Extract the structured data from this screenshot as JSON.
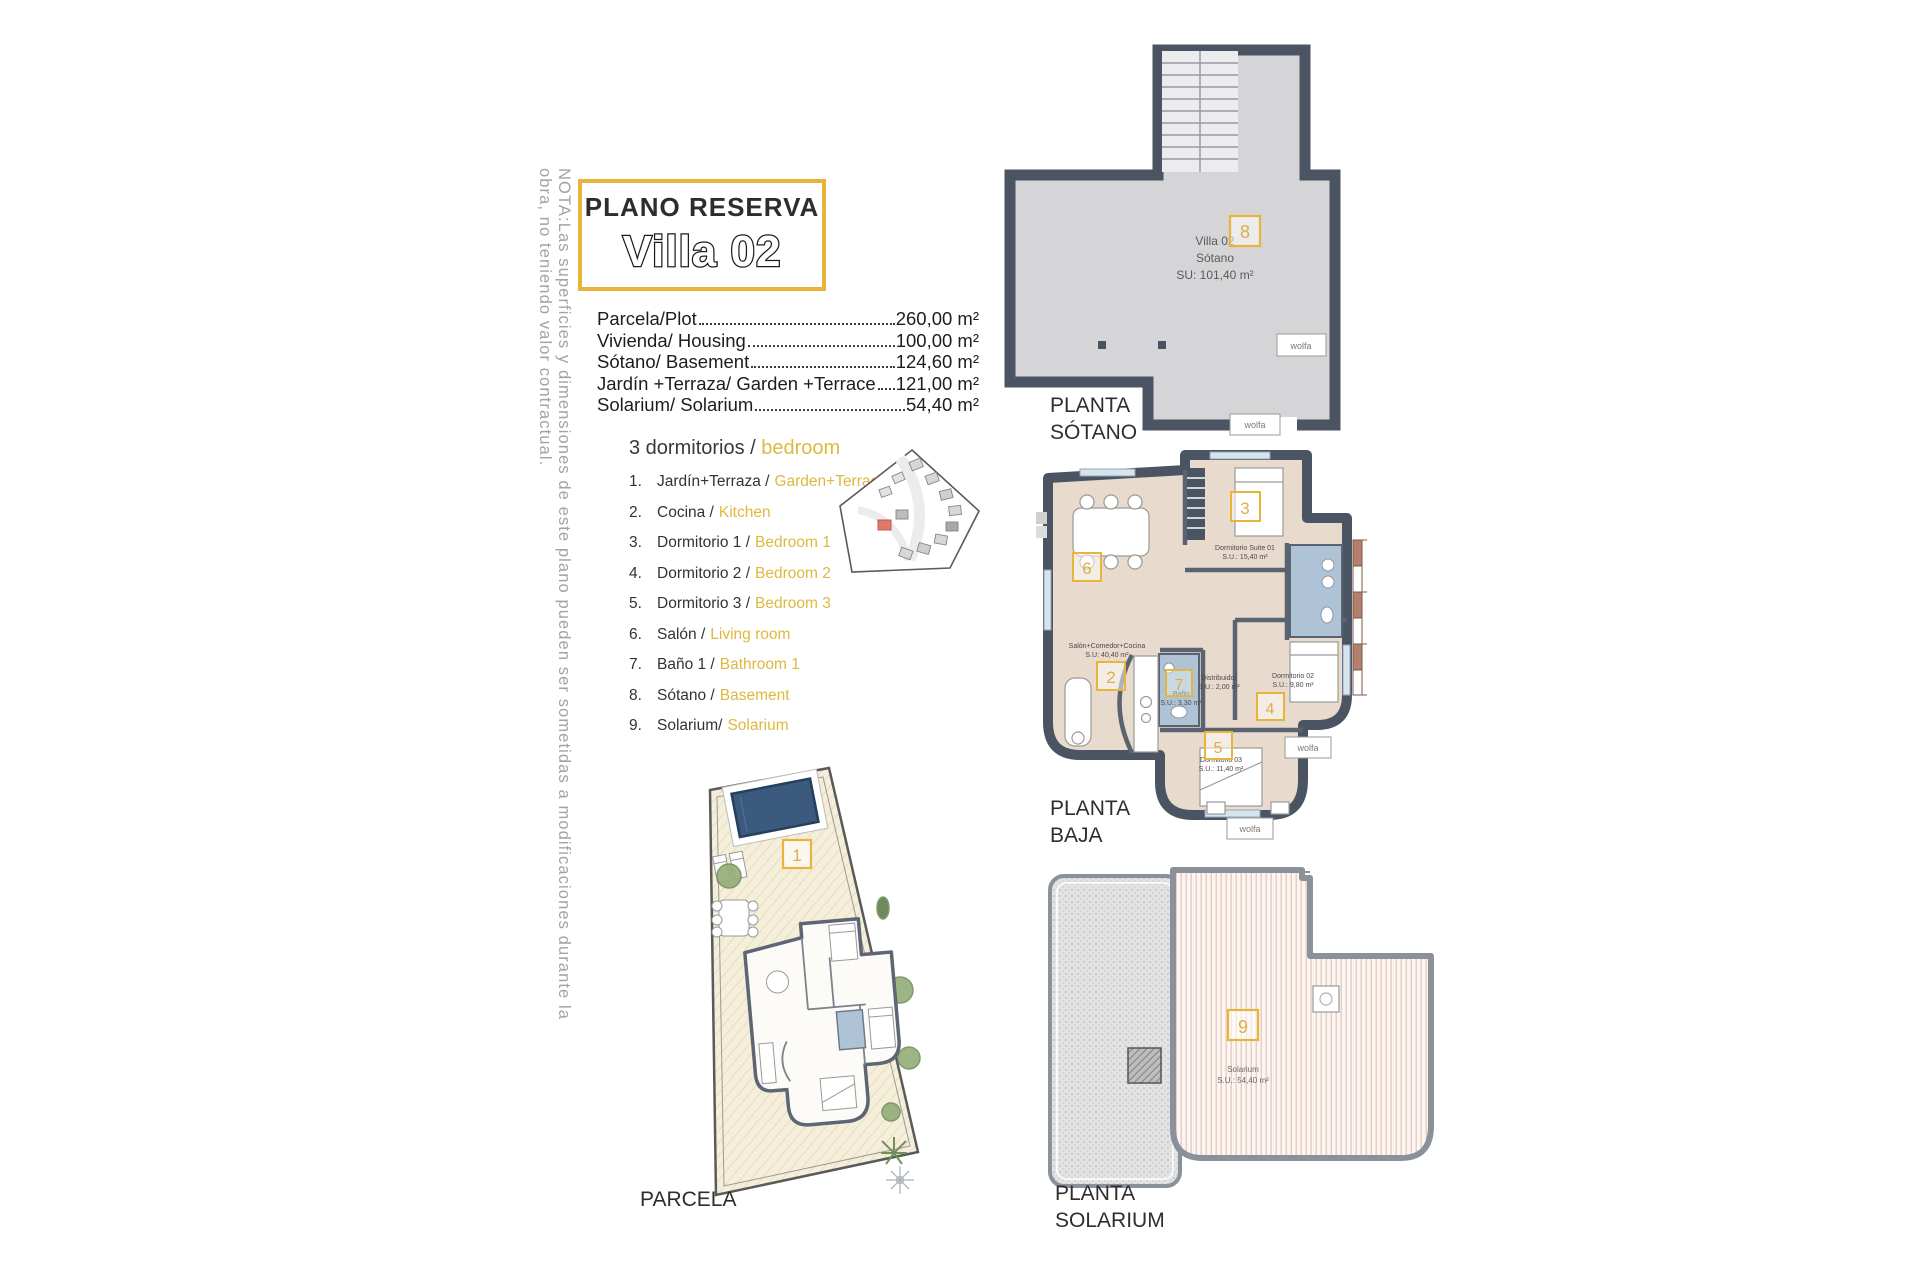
{
  "note": "NOTA:Las superficies y dimensiones de este plano pueden ser sometidas a modificaciones durante la obra, no teniendo valor contractual.",
  "title": {
    "kicker": "PLANO RESERVA",
    "name": "Villa 02"
  },
  "measurements": [
    {
      "label": "Parcela/Plot",
      "value": "260,00 m²"
    },
    {
      "label": "Vivienda/ Housing",
      "value": "100,00 m²"
    },
    {
      "label": "Sótano/ Basement",
      "value": "124,60 m²"
    },
    {
      "label": "Jardín +Terraza/ Garden +Terrace",
      "value": "121,00 m²"
    },
    {
      "label": "Solarium/ Solarium",
      "value": "54,40 m²"
    }
  ],
  "legend": {
    "heading": {
      "es": "3 dormitorios /",
      "en": "bedroom"
    },
    "items": [
      {
        "n": "1.",
        "es": "Jardín+Terraza /",
        "en": "Garden+Terrace"
      },
      {
        "n": "2.",
        "es": "Cocina /",
        "en": "Kitchen"
      },
      {
        "n": "3.",
        "es": "Dormitorio 1 /",
        "en": "Bedroom 1"
      },
      {
        "n": "4.",
        "es": "Dormitorio 2 /",
        "en": "Bedroom 2"
      },
      {
        "n": "5.",
        "es": "Dormitorio 3 /",
        "en": "Bedroom 3"
      },
      {
        "n": "6.",
        "es": "Salón /",
        "en": "Living room"
      },
      {
        "n": "7.",
        "es": "Baño 1 /",
        "en": "Bathroom 1"
      },
      {
        "n": "8.",
        "es": "Sótano /",
        "en": "Basement"
      },
      {
        "n": "9.",
        "es": "Solarium/",
        "en": "Solarium"
      }
    ]
  },
  "plans": {
    "sotano": {
      "label1": "PLANTA",
      "label2": "SÓTANO",
      "badge": "8",
      "room": {
        "l1": "Villa 02",
        "l2": "Sótano",
        "l3": "SU: 101,40 m²"
      },
      "logo": "wolfa"
    },
    "baja": {
      "label1": "PLANTA",
      "label2": "BAJA",
      "rooms": {
        "suite": {
          "badge": "3",
          "name": "Dormitorio Suite 01",
          "area": "S.U.: 15,40 m²"
        },
        "salon": {
          "badge": "6",
          "name": "Salón+Comedor+Cocina",
          "area": "S.U: 40,40 m²"
        },
        "cocina": {
          "badge": "2"
        },
        "bano": {
          "badge": "7",
          "name": "Baño",
          "area": "S.U.: 3,30 m²"
        },
        "distribuidor": {
          "name": "Distribuidor",
          "area": "S.U.: 2,00 m²"
        },
        "dorm2": {
          "badge": "4",
          "name": "Dormitorio 02",
          "area": "S.U.: 9,80 m²"
        },
        "dorm3": {
          "badge": "5",
          "name": "Dormitorio 03",
          "area": "S.U.: 11,40 m²"
        }
      },
      "logo": "wolfa"
    },
    "solarium": {
      "label1": "PLANTA",
      "label2": "SOLARIUM",
      "badge": "9",
      "room": {
        "name": "Solarium",
        "area": "S.U.: 54,40 m²"
      }
    },
    "parcela": {
      "label": "PARCELA",
      "badge": "1"
    }
  },
  "colors": {
    "accent": "#E7B53C",
    "legend_yellow": "#DFB83F",
    "wall": "#4A5462",
    "room_beige": "#E8DACC",
    "bath_blue": "#AEC3D6",
    "basement_gray": "#D5D5D8",
    "highlight_house": "#E0796A"
  }
}
